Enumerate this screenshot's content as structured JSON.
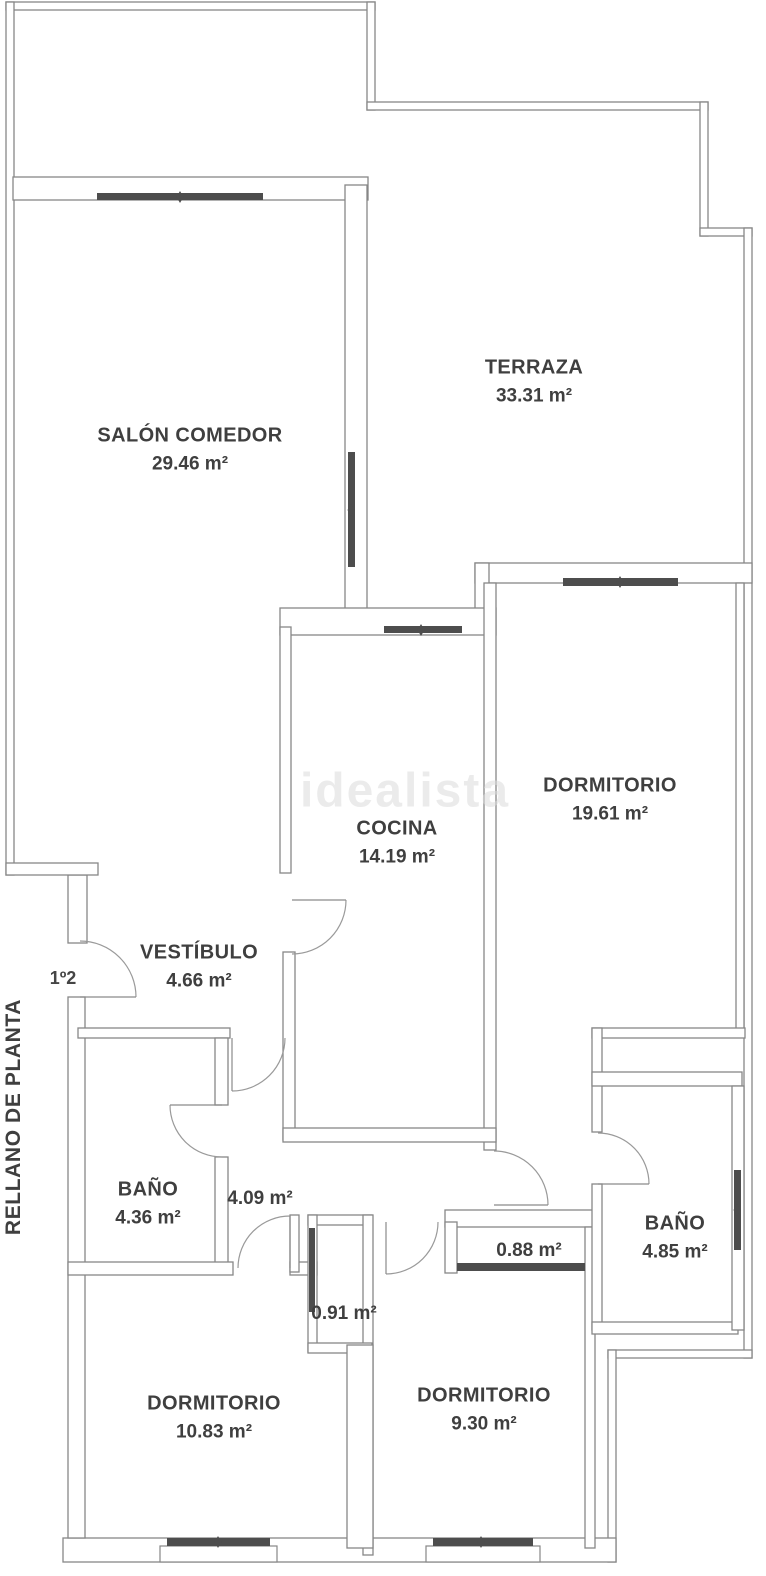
{
  "floorplan": {
    "watermark": "idealista",
    "landing_label": "RELLANO DE PLANTA",
    "entrance_door_label": "1º2",
    "rooms": {
      "terraza": {
        "name": "TERRAZA",
        "area": "33.31 m²"
      },
      "salon_comedor": {
        "name": "SALÓN COMEDOR",
        "area": "29.46 m²"
      },
      "cocina": {
        "name": "COCINA",
        "area": "14.19 m²"
      },
      "dormitorio_1": {
        "name": "DORMITORIO",
        "area": "19.61 m²"
      },
      "vestibulo": {
        "name": "VESTÍBULO",
        "area": "4.66 m²"
      },
      "bano_1": {
        "name": "BAÑO",
        "area": "4.36 m²"
      },
      "pasillo": {
        "area": "4.09 m²"
      },
      "armario_1": {
        "area": "0.91 m²"
      },
      "armario_2": {
        "area": "0.88 m²"
      },
      "bano_2": {
        "name": "BAÑO",
        "area": "4.85 m²"
      },
      "dormitorio_2": {
        "name": "DORMITORIO",
        "area": "10.83 m²"
      },
      "dormitorio_3": {
        "name": "DORMITORIO",
        "area": "9.30 m²"
      }
    },
    "colors": {
      "wall_line": "#878787",
      "window_fill": "#4d4d4d",
      "label_text": "#3f3f3f",
      "watermark_color": "#dcdcdc"
    }
  }
}
